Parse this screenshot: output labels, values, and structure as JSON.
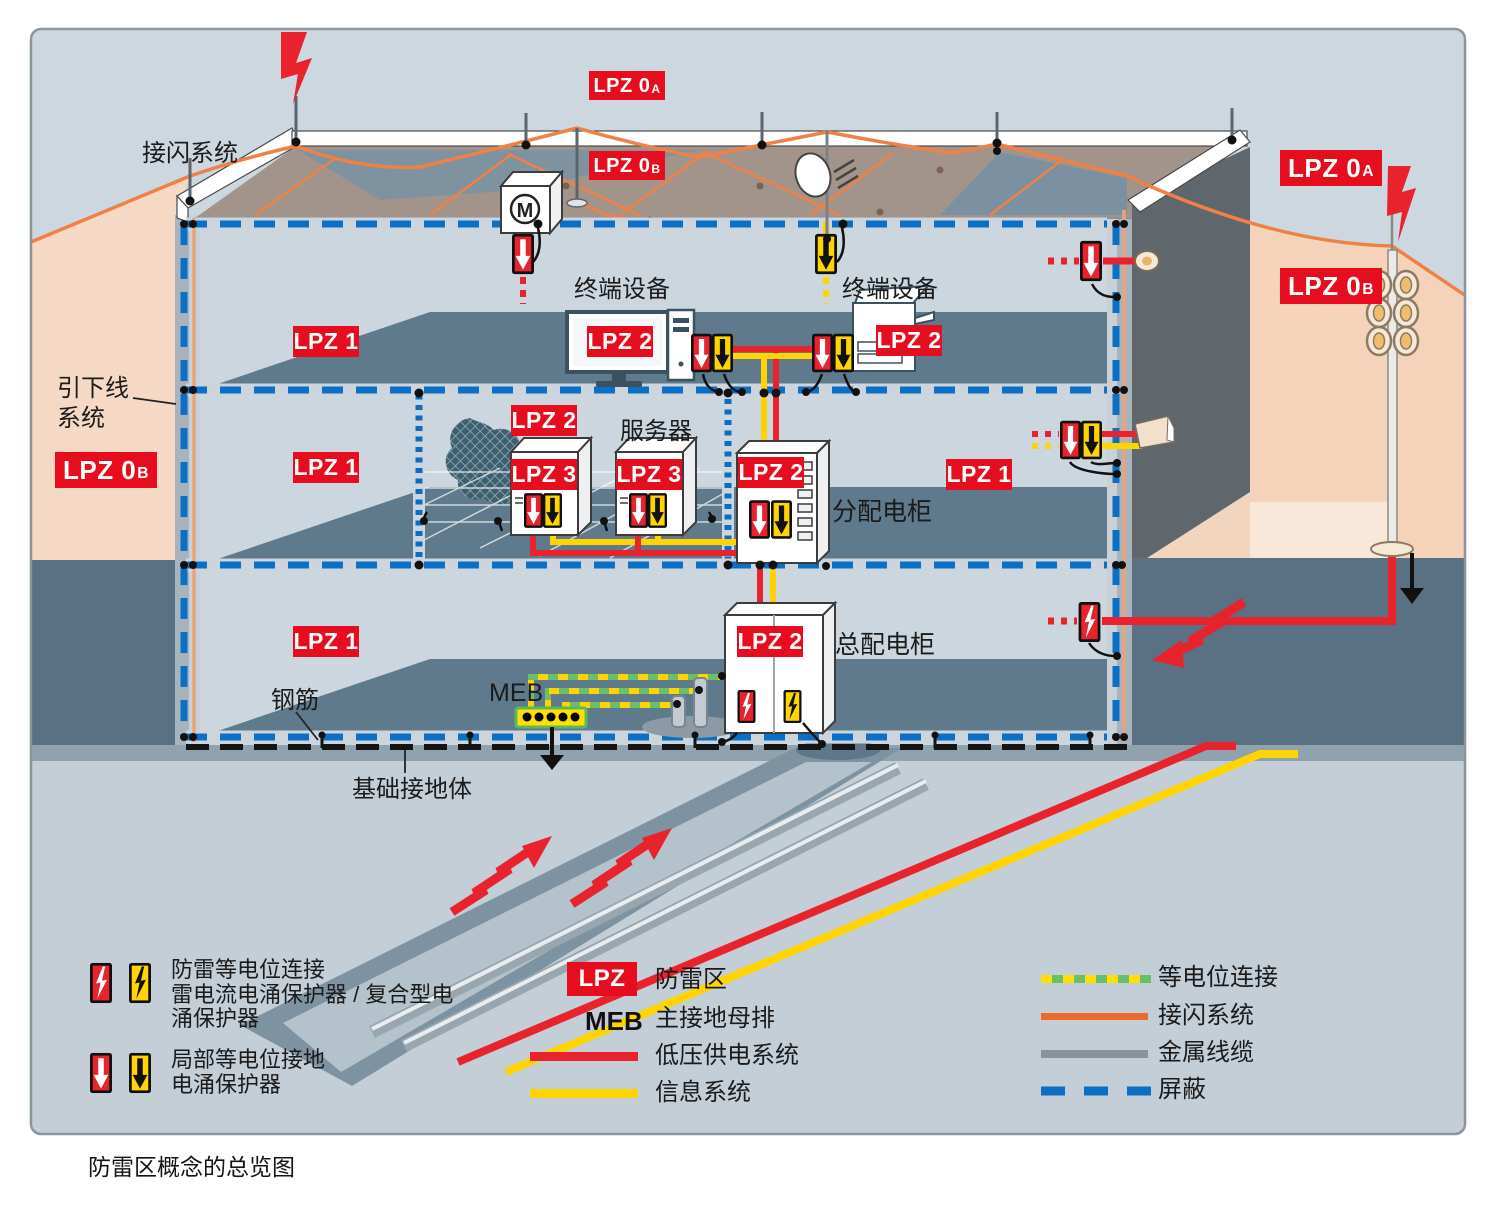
{
  "caption": "防雷区概念的总览图",
  "zones": {
    "lpz0a": {
      "text": "LPZ 0",
      "sub": "A"
    },
    "lpz0b": {
      "text": "LPZ 0",
      "sub": "B"
    },
    "lpz1": "LPZ 1",
    "lpz2": "LPZ 2",
    "lpz3": "LPZ 3"
  },
  "labels": {
    "air_termination": "接闪系统",
    "down_conductor_1": "引下线",
    "down_conductor_2": "系统",
    "terminal_left": "终端设备",
    "terminal_right": "终端设备",
    "server": "服务器",
    "distribution_cabinet": "分配电柜",
    "main_distribution_cabinet": "总配电柜",
    "rebar": "钢筋",
    "meb": "MEB",
    "foundation_earth": "基础接地体",
    "motor": "M"
  },
  "legend": {
    "lightning_spd": {
      "line1": "防雷等电位连接",
      "line2": "雷电流电涌保护器 / 复合型电",
      "line3": "涌保护器"
    },
    "local_spd": {
      "line1": "局部等电位接地",
      "line2": "电涌保护器"
    },
    "lpz": {
      "badge": "LPZ",
      "label": "防雷区"
    },
    "meb": {
      "abbr": "MEB",
      "label": "主接地母排"
    },
    "power": "低压供电系统",
    "info": "信息系统",
    "bonding": "等电位连接",
    "air_termination": "接闪系统",
    "metal_cable": "金属线缆",
    "shield": "屏蔽"
  },
  "icons": {
    "lightning_spd_icon": "bolt-in-box-arrester",
    "surge_spd_icon": "down-arrow-in-box-arrester",
    "lightning_strike_icon": "red-lightning-bolt",
    "earth_icon": "ground-arrow"
  },
  "colors": {
    "badge_red": "#e60d1f",
    "power_red": "#e8232e",
    "info_yellow": "#ffd400",
    "bonding_green": "#6abf69",
    "air_termination_orange": "#ef8147",
    "metal_cable_gray": "#8b9298",
    "shield_blue": "#0c6fc4",
    "zone_peach": "#f5d9c5",
    "ground_dark": "#5a7183",
    "sky": "#cdd7df"
  }
}
